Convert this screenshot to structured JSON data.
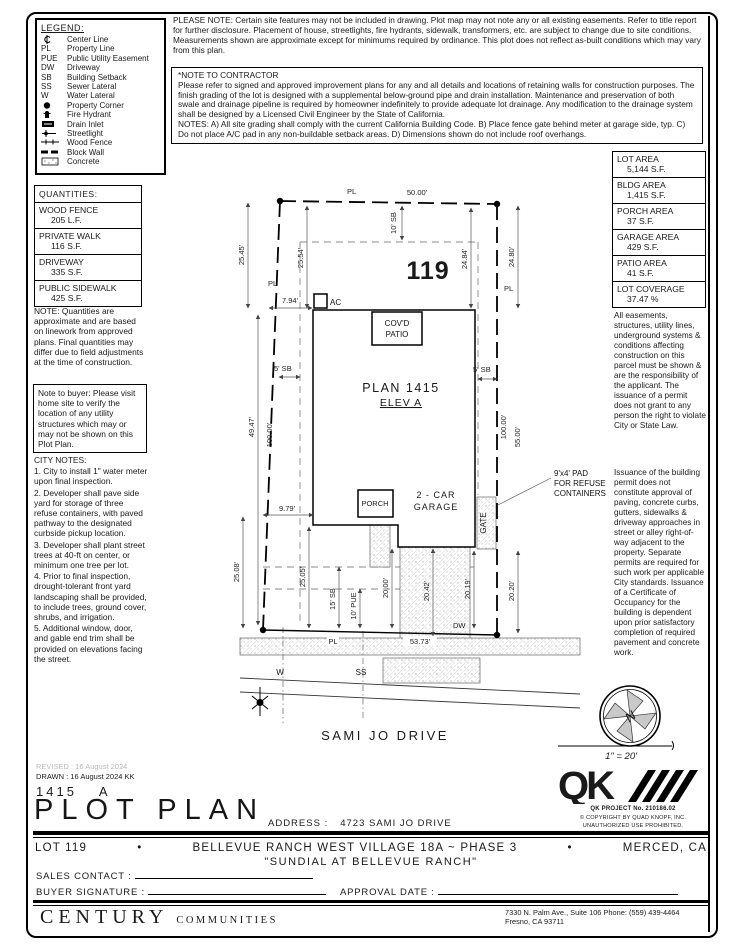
{
  "legend": {
    "title": "LEGEND:",
    "items": [
      {
        "sym": "",
        "label": "Center Line"
      },
      {
        "sym": "PL",
        "label": "Property Line"
      },
      {
        "sym": "PUE",
        "label": "Public Utility Easement"
      },
      {
        "sym": "DW",
        "label": "Driveway"
      },
      {
        "sym": "SB",
        "label": "Building Setback"
      },
      {
        "sym": "SS",
        "label": "Sewer Lateral"
      },
      {
        "sym": "W",
        "label": "Water Lateral"
      },
      {
        "sym": "",
        "label": "Property Corner"
      },
      {
        "sym": "",
        "label": "Fire Hydrant"
      },
      {
        "sym": "",
        "label": "Drain Inlet"
      },
      {
        "sym": "",
        "label": "Streetlight"
      },
      {
        "sym": "",
        "label": "Wood Fence"
      },
      {
        "sym": "",
        "label": "Block Wall"
      },
      {
        "sym": "",
        "label": "Concrete"
      }
    ]
  },
  "top_note": "PLEASE NOTE:  Certain site features may not be included in drawing. Plot map may not note any or all existing easements. Refer to title report for further disclosure. Placement of house, streetlights, fire hydrants, sidewalk, transformers, etc. are subject to change due to site conditions. Measurements shown are approximate except for minimums required by ordinance. This plot does not reflect as-built conditions which may vary from this plan.",
  "contractor_note": {
    "title": "*NOTE TO CONTRACTOR",
    "body": "Please refer to signed and approved improvement plans for any and all details and locations of retaining walls for construction purposes. The finish grading of the lot is designed with a supplemental below-ground pipe and drain installation. Maintenance and preservation of both swale and drainage pipeline is required by homeowner indefinitely to provide adequate lot drainage. Any modification to the drainage system shall be designed by a Licensed Civil Engineer by the State of California.",
    "notes": "NOTES:  A) All site grading shall comply with the current California Building Code.  B) Place fence gate behind meter at garage side, typ. C) Do not place A/C pad in any non-buildable setback areas.  D) Dimensions shown do not include roof overhangs."
  },
  "quantities": {
    "title": "QUANTITIES:",
    "rows": [
      {
        "name": "WOOD FENCE",
        "value": "205 L.F."
      },
      {
        "name": "PRIVATE WALK",
        "value": "116 S.F."
      },
      {
        "name": "DRIVEWAY",
        "value": "335 S.F."
      },
      {
        "name": "PUBLIC SIDEWALK",
        "value": "425 S.F."
      }
    ],
    "note": "NOTE: Quantities are approximate and are based on linework from approved plans.  Final quantities may differ due to field adjustments at the time of construction."
  },
  "buyer_note": "Note to buyer: Please visit home site to verify the location of any utility structures which may or may not be shown on this Plot Plan.",
  "city_notes": {
    "title": "CITY NOTES:",
    "items": [
      "1. City to install 1\" water meter upon final inspection.",
      "2. Developer shall pave side yard for storage of three refuse containers, with paved pathway to the designated curbside pickup location.",
      "3. Developer shall plant street trees at 40-ft on center, or minimum one tree per lot.",
      "4. Prior to final inspection, drought-tolerant front yard landscaping shall be provided, to include trees, ground cover, shrubs, and irrigation.",
      "5. Additional window, door, and gable end trim shall be provided on elevations facing the street."
    ]
  },
  "areas": {
    "rows": [
      {
        "name": "LOT AREA",
        "value": "5,144 S.F."
      },
      {
        "name": "BLDG AREA",
        "value": "1,415 S.F."
      },
      {
        "name": "PORCH AREA",
        "value": "37 S.F."
      },
      {
        "name": "GARAGE AREA",
        "value": "429 S.F."
      },
      {
        "name": "PATIO AREA",
        "value": "41 S.F."
      },
      {
        "name": "LOT COVERAGE",
        "value": "37.47 %"
      }
    ]
  },
  "easement_note": "All easements, structures, utility lines, underground systems & conditions affecting construction on this parcel must be shown & are the responsibility of the applicant. The issuance of a permit does not grant to any person the right to violate City or State Law.",
  "permit_note": "Issuance of the building permit does not constitute approval of paving, concrete curbs, gutters, sidewalks & driveway approaches in street or alley right-of-way adjacent to the property. Separate permits are required for such work per applicable City standards. Issuance of a Certificate of Occupancy for the building is dependent upon prior satisfactory completion of required pavement and concrete work.",
  "plot": {
    "lot_number": "119",
    "plan_name": "PLAN 1415",
    "elev": "ELEV A",
    "covd_patio_1": "COV'D",
    "covd_patio_2": "PATIO",
    "ac": "AC",
    "porch": "PORCH",
    "garage_1": "2 - CAR",
    "garage_2": "GARAGE",
    "gate": "GATE",
    "dw": "DW",
    "pl": "PL",
    "w": "W",
    "ss": "SS",
    "street_name": "SAMI JO DRIVE",
    "refuse_1": "9'x4' PAD",
    "refuse_2": "FOR REFUSE",
    "refuse_3": "CONTAINERS",
    "dims": {
      "top": "50.00'",
      "bottom": "53.73'",
      "left_outer": "25.45'",
      "left_inner": "25.54'",
      "right_inner": "24.84'",
      "right_outer": "24.80'",
      "rear_sb": "10' SB",
      "side_sb_left": "5' SB",
      "side_sb_right": "5' SB",
      "ac_offset": "7.94'",
      "left_len_1": "49.47'",
      "left_len_2": "100.00'",
      "right_len_1": "100.00'",
      "right_len_2": "55.00'",
      "porch_offset": "9.79'",
      "front_left_outer": "25.08'",
      "front_left_inner": "25.05'",
      "front_sb": "15' SB",
      "pue": "10' PUE",
      "drive_1": "20.00'",
      "drive_2": "20.42'",
      "drive_3": "20.19'",
      "drive_4": "20.20'"
    }
  },
  "compass": {
    "letter": "N",
    "scale": "1\" = 20'"
  },
  "qk": {
    "project": "QK PROJECT No. 210186.02",
    "copyright": "© COPYRIGHT BY QUAD KNOPF, INC.",
    "unauthorized": "UNAUTHORIZED USE PROHIBITED."
  },
  "titleblock": {
    "revised": "REVISED : 16 August 2024",
    "drawn": "DRAWN : 16 August 2024  KK",
    "plan": "1415",
    "elev": "A",
    "title": "PLOT PLAN",
    "address_label": "ADDRESS :",
    "address": "4723 SAMI JO DRIVE",
    "lot": "LOT 119",
    "bullet": "•",
    "community": "BELLEVUE RANCH WEST VILLAGE 18A ~ PHASE 3",
    "city": "MERCED, CA",
    "subtitle": "\"SUNDIAL AT BELLEVUE RANCH\"",
    "sales_label": "SALES CONTACT :",
    "buyer_label": "BUYER SIGNATURE :",
    "approval_label": "APPROVAL DATE :"
  },
  "footer": {
    "brand": "CENTURY",
    "brand_suffix": "COMMUNITIES",
    "address_line1": "7330 N. Palm Ave., Suite 106    Phone:  (559) 439-4464",
    "address_line2": "Fresno, CA  93711"
  }
}
